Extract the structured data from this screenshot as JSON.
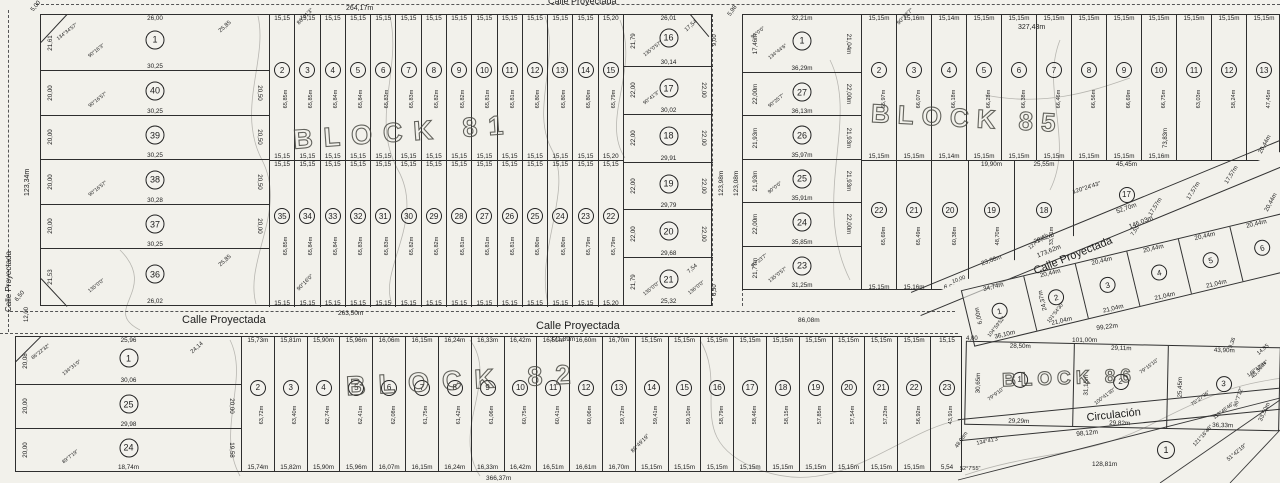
{
  "block81": {
    "name": "BLOCK 81",
    "west": [
      {
        "n": "1",
        "top": "26,00",
        "left": "21,61",
        "diag": "25,85",
        "bottom": "30,25",
        "a1": "90°16'3\"",
        "a2": "134°34'57\""
      },
      {
        "n": "40",
        "left": "20,00",
        "right": "20,50",
        "bottom": "30,25",
        "a1": "90°16'57\""
      },
      {
        "n": "39",
        "left": "20,00",
        "right": "20,50",
        "bottom": "30,25"
      },
      {
        "n": "38",
        "left": "20,00",
        "right": "20,50",
        "bottom": "30,28",
        "a1": "90°16'57\""
      },
      {
        "n": "37",
        "left": "20,00",
        "right": "20,00",
        "bottom": "30,25"
      },
      {
        "n": "36",
        "left": "21,53",
        "diag": "25,85",
        "bottom": "26,02",
        "a1": "135°0'0\""
      }
    ],
    "north": [
      {
        "n": "2",
        "t": "15,15",
        "b": "15,15",
        "d": "65,85m"
      },
      {
        "n": "3",
        "t": "15,15",
        "b": "15,15",
        "d": "65,85m"
      },
      {
        "n": "4",
        "t": "15,15",
        "b": "15,15",
        "d": "65,84m"
      },
      {
        "n": "5",
        "t": "15,15",
        "b": "15,15",
        "d": "65,84m"
      },
      {
        "n": "6",
        "t": "15,15",
        "b": "15,15",
        "d": "65,83m"
      },
      {
        "n": "7",
        "t": "15,15",
        "b": "15,15",
        "d": "65,83m"
      },
      {
        "n": "8",
        "t": "15,15",
        "b": "15,15",
        "d": "65,82m"
      },
      {
        "n": "9",
        "t": "15,15",
        "b": "15,15",
        "d": "65,82m"
      },
      {
        "n": "10",
        "t": "15,15",
        "b": "15,15",
        "d": "65,81m"
      },
      {
        "n": "11",
        "t": "15,15",
        "b": "15,15",
        "d": "65,81m"
      },
      {
        "n": "12",
        "t": "15,15",
        "b": "15,15",
        "d": "65,80m"
      },
      {
        "n": "13",
        "t": "15,15",
        "b": "15,15",
        "d": "65,80m"
      },
      {
        "n": "14",
        "t": "15,15",
        "b": "15,15",
        "d": "65,80m"
      },
      {
        "n": "15",
        "t": "15,20",
        "b": "15,20",
        "d": "65,79m"
      }
    ],
    "south": [
      {
        "n": "35",
        "t": "15,15",
        "b": "15,15",
        "d": "65,85m"
      },
      {
        "n": "34",
        "t": "15,15",
        "b": "15,15",
        "d": "65,84m"
      },
      {
        "n": "33",
        "t": "15,15",
        "b": "15,15",
        "d": "65,84m"
      },
      {
        "n": "32",
        "t": "15,15",
        "b": "15,15",
        "d": "65,83m"
      },
      {
        "n": "31",
        "t": "15,15",
        "b": "15,15",
        "d": "65,83m"
      },
      {
        "n": "30",
        "t": "15,15",
        "b": "15,15",
        "d": "65,82m"
      },
      {
        "n": "29",
        "t": "15,15",
        "b": "15,15",
        "d": "65,82m"
      },
      {
        "n": "28",
        "t": "15,15",
        "b": "15,15",
        "d": "65,81m"
      },
      {
        "n": "27",
        "t": "15,15",
        "b": "15,15",
        "d": "65,81m"
      },
      {
        "n": "26",
        "t": "15,15",
        "b": "15,15",
        "d": "65,81m"
      },
      {
        "n": "25",
        "t": "15,15",
        "b": "15,15",
        "d": "65,80m"
      },
      {
        "n": "24",
        "t": "15,15",
        "b": "15,15",
        "d": "65,80m"
      },
      {
        "n": "23",
        "t": "15,15",
        "b": "15,15",
        "d": "65,79m"
      },
      {
        "n": "22",
        "t": "15,15",
        "b": "15,20",
        "d": "65,79m"
      }
    ],
    "east": [
      {
        "n": "16",
        "top": "26,01",
        "left": "21,79",
        "diag": "17,54",
        "bottom": "30,14",
        "a1": "135°0'57\""
      },
      {
        "n": "17",
        "left": "22,00",
        "right": "22,00",
        "bottom": "30,02",
        "a1": "90°41'3\""
      },
      {
        "n": "18",
        "left": "22,00",
        "right": "22,00",
        "bottom": "29,91"
      },
      {
        "n": "19",
        "left": "22,00",
        "right": "22,00",
        "bottom": "29,79"
      },
      {
        "n": "20",
        "left": "22,00",
        "right": "22,00",
        "bottom": "29,68"
      },
      {
        "n": "21",
        "left": "21,79",
        "diag": "7,54",
        "bottom": "25,32",
        "a1": "135°0'0\"",
        "a2": "136°0'0\""
      }
    ]
  },
  "block85": {
    "name": "BLOCK 85",
    "west": [
      {
        "n": "1",
        "top": "32,21m",
        "left": "17,46m",
        "right": "21,04m",
        "bottom": "36,29m",
        "a1": "134°44'6\"",
        "a2": "90°0'0\""
      },
      {
        "n": "27",
        "left": "22,00m",
        "right": "22,00m",
        "bottom": "36,13m",
        "a1": "90°25'7\""
      },
      {
        "n": "26",
        "left": "21,93m",
        "right": "21,93m",
        "bottom": "35,97m"
      },
      {
        "n": "25",
        "left": "21,93m",
        "right": "21,93m",
        "bottom": "35,91m",
        "a1": "90°0'0\""
      },
      {
        "n": "24",
        "left": "22,00m",
        "right": "22,00m",
        "bottom": "35,85m"
      },
      {
        "n": "23",
        "left": "21,77m",
        "bottom": "31,25m",
        "a1": "135°0'57\"",
        "a2": "90°23'7\""
      }
    ],
    "north": [
      {
        "n": "2",
        "t": "15,15m",
        "b": "15,15m",
        "d": "65,97m"
      },
      {
        "n": "3",
        "t": "15,16m",
        "b": "15,15m",
        "d": "66,07m"
      },
      {
        "n": "4",
        "t": "15,14m",
        "b": "15,14m",
        "d": "66,18m"
      },
      {
        "n": "5",
        "t": "15,15m",
        "b": "15,15m",
        "d": "66,28m"
      },
      {
        "n": "6",
        "t": "15,15m",
        "b": "15,15m",
        "d": "66,38m"
      },
      {
        "n": "7",
        "t": "15,15m",
        "b": "15,15m",
        "d": "66,46m"
      },
      {
        "n": "8",
        "t": "15,15m",
        "b": "15,15m",
        "d": "66,56m"
      },
      {
        "n": "9",
        "t": "15,15m",
        "b": "15,15m",
        "d": "66,69m"
      },
      {
        "n": "10",
        "t": "15,15m",
        "b": "15,16m",
        "d": "66,75m"
      },
      {
        "n": "11",
        "t": "15,15m",
        "d": "63,03m"
      },
      {
        "n": "12",
        "t": "15,15m",
        "d": "58,24m"
      },
      {
        "n": "13",
        "t": "15,15m",
        "d": "47,45m"
      }
    ],
    "south": [
      {
        "n": "22",
        "d": "65,69m",
        "b": "15,15m"
      },
      {
        "n": "21",
        "d": "65,49m",
        "b": "15,16m"
      },
      {
        "n": "20",
        "d": "60,38m",
        "b": "6,52",
        "b2": "10,00"
      },
      {
        "n": "19",
        "t": "19,90m",
        "d": "48,70m",
        "b": "23,08m"
      },
      {
        "n": "18",
        "t": "25,55m",
        "d": "33,71m",
        "b": "29,62m",
        "a1": "127°2'21\""
      },
      {
        "n": "17",
        "t": "45,45m",
        "b": "52,70m"
      }
    ]
  },
  "annex": {
    "lots": [
      {
        "n": "1",
        "t": "34,74m",
        "l": "6,00m",
        "b": "36,10m",
        "a1": "104°59'52\"",
        "a2": "104°59'52\""
      },
      {
        "n": "2",
        "t": "20,44m",
        "l": "24,37m",
        "b": "21,04m",
        "a1": "101°54'30\""
      },
      {
        "n": "3",
        "t": "20,44m",
        "b": "21,04m"
      },
      {
        "n": "4",
        "t": "20,44m",
        "b": "21,04m"
      },
      {
        "n": "5",
        "t": "20,44m",
        "b": "21,04m"
      },
      {
        "n": "6",
        "t": "20,44m"
      }
    ]
  },
  "block82": {
    "name": "BLOCK 82",
    "west": [
      {
        "n": "1",
        "top": "25,96",
        "left": "20,08",
        "diag": "24,14",
        "bottom": "30,06",
        "a1": "134°31'0\"",
        "a2": "86°22'32\""
      },
      {
        "n": "25",
        "left": "20,00",
        "right": "20,00",
        "bottom": "29,98"
      },
      {
        "n": "24",
        "left": "20,00",
        "right": "19,58",
        "bottom": "18,74m",
        "a1": "89°7'19\""
      }
    ],
    "strips": [
      {
        "n": "2",
        "t": "15,73m",
        "b": "15,74m",
        "d": "63,72m"
      },
      {
        "n": "3",
        "t": "15,81m",
        "b": "15,82m",
        "d": "63,40m"
      },
      {
        "n": "4",
        "t": "15,90m",
        "b": "15,90m",
        "d": "62,74m"
      },
      {
        "n": "5",
        "t": "15,96m",
        "b": "15,96m",
        "d": "62,41m"
      },
      {
        "n": "6",
        "t": "16,06m",
        "b": "16,07m",
        "d": "62,08m"
      },
      {
        "n": "7",
        "t": "16,15m",
        "b": "16,15m",
        "d": "61,75m"
      },
      {
        "n": "8",
        "t": "16,24m",
        "b": "16,24m",
        "d": "61,42m"
      },
      {
        "n": "9",
        "t": "16,33m",
        "b": "16,33m",
        "d": "61,06m"
      },
      {
        "n": "10",
        "t": "16,42m",
        "b": "16,42m",
        "d": "60,75m"
      },
      {
        "n": "11",
        "t": "16,51m",
        "b": "16,51m",
        "d": "60,41m"
      },
      {
        "n": "12",
        "t": "16,60m",
        "b": "16,61m",
        "d": "60,06m"
      },
      {
        "n": "13",
        "t": "16,70m",
        "b": "16,70m",
        "d": "59,72m"
      },
      {
        "n": "14",
        "t": "15,15m",
        "b": "15,15m",
        "d": "59,41m"
      },
      {
        "n": "15",
        "t": "15,15m",
        "b": "15,15m",
        "d": "59,10m"
      },
      {
        "n": "16",
        "t": "15,15m",
        "b": "15,15m",
        "d": "58,79m"
      },
      {
        "n": "17",
        "t": "15,15m",
        "b": "15,15m",
        "d": "58,46m"
      },
      {
        "n": "18",
        "t": "15,15m",
        "b": "15,15m",
        "d": "58,15m"
      },
      {
        "n": "19",
        "t": "15,15m",
        "b": "15,15m",
        "d": "57,85m"
      },
      {
        "n": "20",
        "t": "15,15m",
        "b": "15,15m",
        "d": "57,54m"
      },
      {
        "n": "21",
        "t": "15,15m",
        "b": "15,15m",
        "d": "57,23m"
      },
      {
        "n": "22",
        "t": "15,15m",
        "b": "15,15m",
        "d": "56,92m"
      },
      {
        "n": "23",
        "t": "15,15",
        "b": "5,54",
        "d": "43,91m"
      }
    ]
  },
  "block86": {
    "name": "BLOCK 86",
    "lots": [
      {
        "n": "1",
        "t": "28,50m",
        "l": "30,65m",
        "b": "29,29m",
        "a1": "79°9'10\""
      },
      {
        "n": "2",
        "t": "29,11m",
        "l": "31,15m",
        "b": "29,82m",
        "a1": "100°41'30\"",
        "a2": "79°15'10\""
      },
      {
        "n": "3",
        "t": "43,90m",
        "l": "25,45m",
        "b": "36,33m",
        "a1": "75°27'36\"",
        "a2": "148°12'34\"",
        "a3": "112°46'46\""
      }
    ]
  },
  "circ": {
    "lot_n": "1"
  },
  "annotations": [
    {
      "t": "Calle Proyectada",
      "x": 548,
      "y": -4,
      "s": 9
    },
    {
      "t": "264,17m",
      "x": 346,
      "y": 5
    },
    {
      "t": "327,43m",
      "x": 1018,
      "y": 24
    },
    {
      "t": "Calle Proyectada",
      "x": 4,
      "y": 312,
      "r": -90,
      "s": 8
    },
    {
      "t": "123,34m",
      "x": 24,
      "y": 196,
      "r": -90
    },
    {
      "t": "5,00",
      "x": 30,
      "y": 9,
      "r": -50,
      "s": 6
    },
    {
      "t": "123,98m",
      "x": 718,
      "y": 196,
      "r": -90,
      "s": 6.5
    },
    {
      "t": "123,08m",
      "x": 733,
      "y": 196,
      "r": -90,
      "s": 6.5
    },
    {
      "t": "9,00",
      "x": 712,
      "y": 46,
      "r": -90,
      "s": 6
    },
    {
      "t": "5,98",
      "x": 727,
      "y": 14,
      "r": -55,
      "s": 6
    },
    {
      "t": "6,50",
      "x": 712,
      "y": 296,
      "r": -90,
      "s": 6
    },
    {
      "t": "6,50",
      "x": 14,
      "y": 299,
      "r": -50,
      "s": 6
    },
    {
      "t": "Calle Proyectada",
      "x": 182,
      "y": 314,
      "s": 11
    },
    {
      "t": "263,50m",
      "x": 338,
      "y": 310,
      "s": 6.5
    },
    {
      "t": "Calle Proyectada",
      "x": 536,
      "y": 320,
      "s": 11
    },
    {
      "t": "371,89m",
      "x": 550,
      "y": 336,
      "s": 6.5
    },
    {
      "t": "86,08m",
      "x": 798,
      "y": 317,
      "s": 6.5
    },
    {
      "t": "12,00",
      "x": 24,
      "y": 322,
      "r": -90,
      "s": 6
    },
    {
      "t": "Calle Proyectada",
      "x": 1032,
      "y": 266,
      "r": -22,
      "s": 11
    },
    {
      "t": "146,03m",
      "x": 1128,
      "y": 224,
      "r": -22,
      "s": 6.5
    },
    {
      "t": "173,62m",
      "x": 1036,
      "y": 253,
      "r": -22,
      "s": 6.5
    },
    {
      "t": "120°24'43\"",
      "x": 1072,
      "y": 190,
      "r": -18,
      "s": 6
    },
    {
      "t": "17,57m",
      "x": 1148,
      "y": 214,
      "r": -58,
      "s": 6
    },
    {
      "t": "17,57m",
      "x": 1186,
      "y": 198,
      "r": -58,
      "s": 6
    },
    {
      "t": "17,57m",
      "x": 1224,
      "y": 182,
      "r": -58,
      "s": 6
    },
    {
      "t": "7,55",
      "x": 1130,
      "y": 234,
      "r": -58,
      "s": 5.5
    },
    {
      "t": "73,83m",
      "x": 1163,
      "y": 148,
      "r": -90,
      "s": 6
    },
    {
      "t": "99,22m",
      "x": 1096,
      "y": 325,
      "r": -7,
      "s": 6.5
    },
    {
      "t": "101,00m",
      "x": 1072,
      "y": 337,
      "s": 6.5
    },
    {
      "t": "4,00",
      "x": 966,
      "y": 336,
      "s": 6
    },
    {
      "t": "20,44m",
      "x": 1258,
      "y": 152,
      "r": -62,
      "s": 6
    },
    {
      "t": "20,44m",
      "x": 1264,
      "y": 210,
      "r": -62,
      "s": 6
    },
    {
      "t": "45,30m",
      "x": 1250,
      "y": 376,
      "r": -48,
      "s": 6
    },
    {
      "t": "Circulación",
      "x": 1086,
      "y": 412,
      "r": -6,
      "s": 11
    },
    {
      "t": "98,12m",
      "x": 1076,
      "y": 431,
      "r": -6,
      "s": 6.5
    },
    {
      "t": "128,81m",
      "x": 1092,
      "y": 461,
      "s": 6.5
    },
    {
      "t": "121°16'48\"",
      "x": 1192,
      "y": 444,
      "r": -48,
      "s": 5.5
    },
    {
      "t": "96°7'12\"",
      "x": 1233,
      "y": 406,
      "r": -72,
      "s": 5.5
    },
    {
      "t": "51°42'19\"",
      "x": 1226,
      "y": 458,
      "r": -40,
      "s": 5.5
    },
    {
      "t": "134°41'3\"",
      "x": 976,
      "y": 441,
      "r": -12,
      "s": 5.5
    },
    {
      "t": "52°7'55\"",
      "x": 960,
      "y": 466,
      "s": 5.5
    },
    {
      "t": "48,98m",
      "x": 954,
      "y": 446,
      "r": -55,
      "s": 5.5
    },
    {
      "t": "33,50m",
      "x": 1258,
      "y": 420,
      "r": -65,
      "s": 6
    },
    {
      "t": "366,37m",
      "x": 486,
      "y": 475,
      "s": 6.5
    },
    {
      "t": "86°49'19\"",
      "x": 630,
      "y": 450,
      "r": -45,
      "s": 5.5
    },
    {
      "t": "90°16'0\"",
      "x": 296,
      "y": 288,
      "r": -45,
      "s": 5.5
    },
    {
      "t": "86°41'3\"",
      "x": 296,
      "y": 22,
      "r": -45,
      "s": 5.5
    },
    {
      "t": "90°23'7\"",
      "x": 896,
      "y": 22,
      "r": -45,
      "s": 5.5
    },
    {
      "t": "9,36",
      "x": 1228,
      "y": 347,
      "r": -70,
      "s": 5.5
    },
    {
      "t": "14,85",
      "x": 1256,
      "y": 352,
      "r": -40,
      "s": 5.5
    }
  ]
}
